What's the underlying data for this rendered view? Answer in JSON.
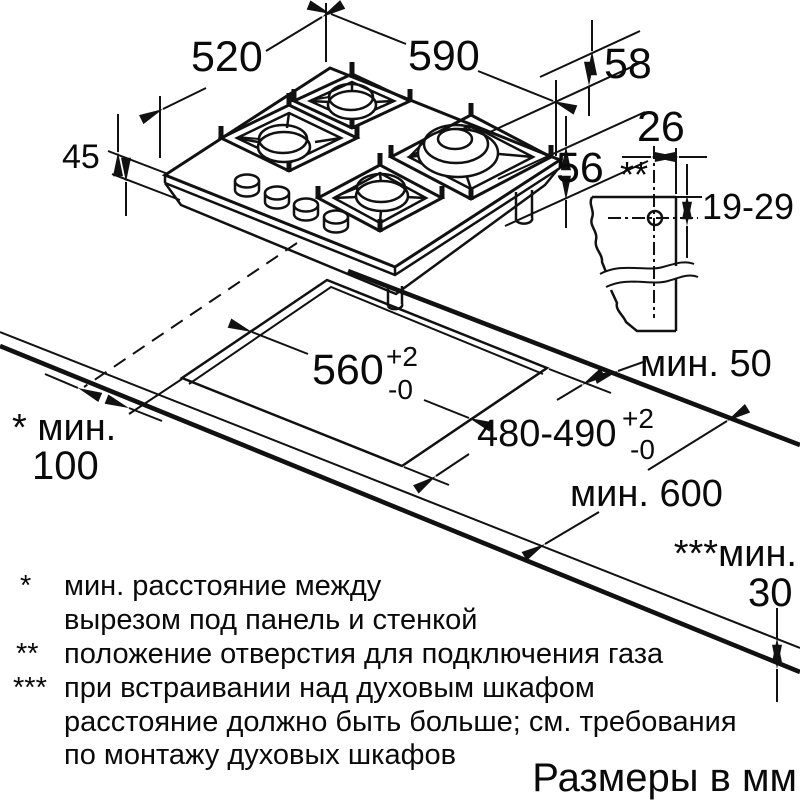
{
  "units_note": "Размеры в мм",
  "dimensions": {
    "hob_depth": "520",
    "hob_width": "590",
    "clearance_above": "58",
    "hob_height": "45",
    "clearance_below": "56",
    "gas_offset_x": "26",
    "gas_offset_y": "19-29",
    "gas_marker": "**"
  },
  "cutout": {
    "width": "560",
    "width_tol_plus": "+2",
    "width_tol_minus": "-0",
    "depth": "480-490",
    "depth_tol_plus": "+2",
    "depth_tol_minus": "-0"
  },
  "clearances": {
    "rear": "мин. 50",
    "side_label": "* мин.",
    "side_value": "100",
    "front": "мин. 600",
    "below_label": "***мин.",
    "below_value": "30"
  },
  "footnotes": [
    {
      "marker": "*",
      "lines": [
        "мин. расстояние между",
        "вырезом под панель и стенкой"
      ]
    },
    {
      "marker": "**",
      "lines": [
        "положение отверстия для подключения газа"
      ]
    },
    {
      "marker": "***",
      "lines": [
        "при встраивании над духовым шкафом",
        "расстояние должно быть больше; см. требования",
        "по монтажу духовых шкафов"
      ]
    }
  ],
  "colors": {
    "line": "#111111",
    "burner_cap": "#c9c9c9"
  }
}
